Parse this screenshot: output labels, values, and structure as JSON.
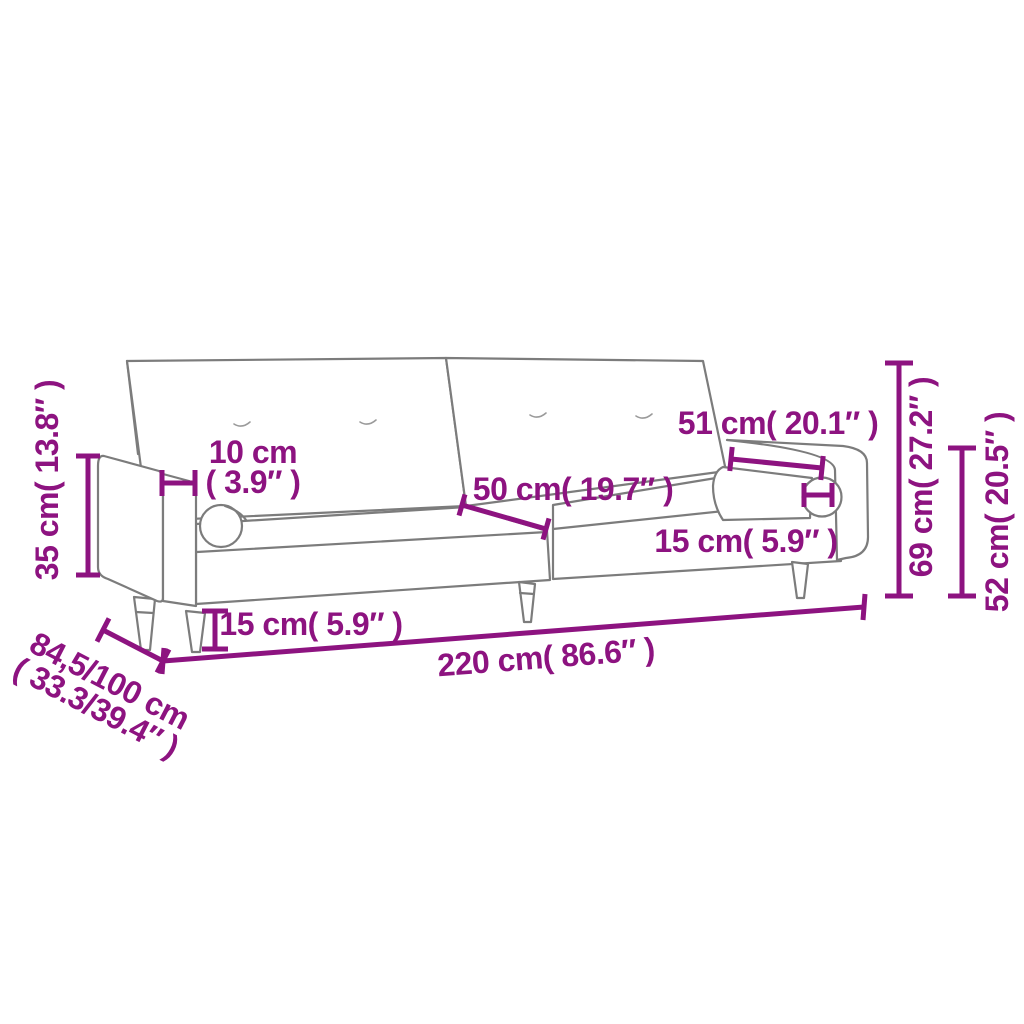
{
  "page": {
    "background": "#ffffff"
  },
  "drawing": {
    "subject": "two-seater sofa bed with armrests and bolster cushions",
    "line_color": "#7c7c7c",
    "accent_color": "#8d1380"
  },
  "labels": {
    "armrest_height": "35 cm( 13.8″ )",
    "armrest_width": {
      "line1": "10 cm",
      "line2": "( 3.9″ )"
    },
    "seat_depth": "50 cm( 19.7″ )",
    "armrest_length": "51 cm( 20.1″ )",
    "bolster_diameter": "15 cm( 5.9″ )",
    "leg_height": "15 cm( 5.9″ )",
    "overall_width": "220 cm( 86.6″ )",
    "depth_range": {
      "line1": "84,5/100 cm",
      "line2": "( 33.3/39.4″ )"
    },
    "overall_height": "69 cm( 27.2″ )",
    "backrest_height": "52 cm( 20.5″ )"
  }
}
